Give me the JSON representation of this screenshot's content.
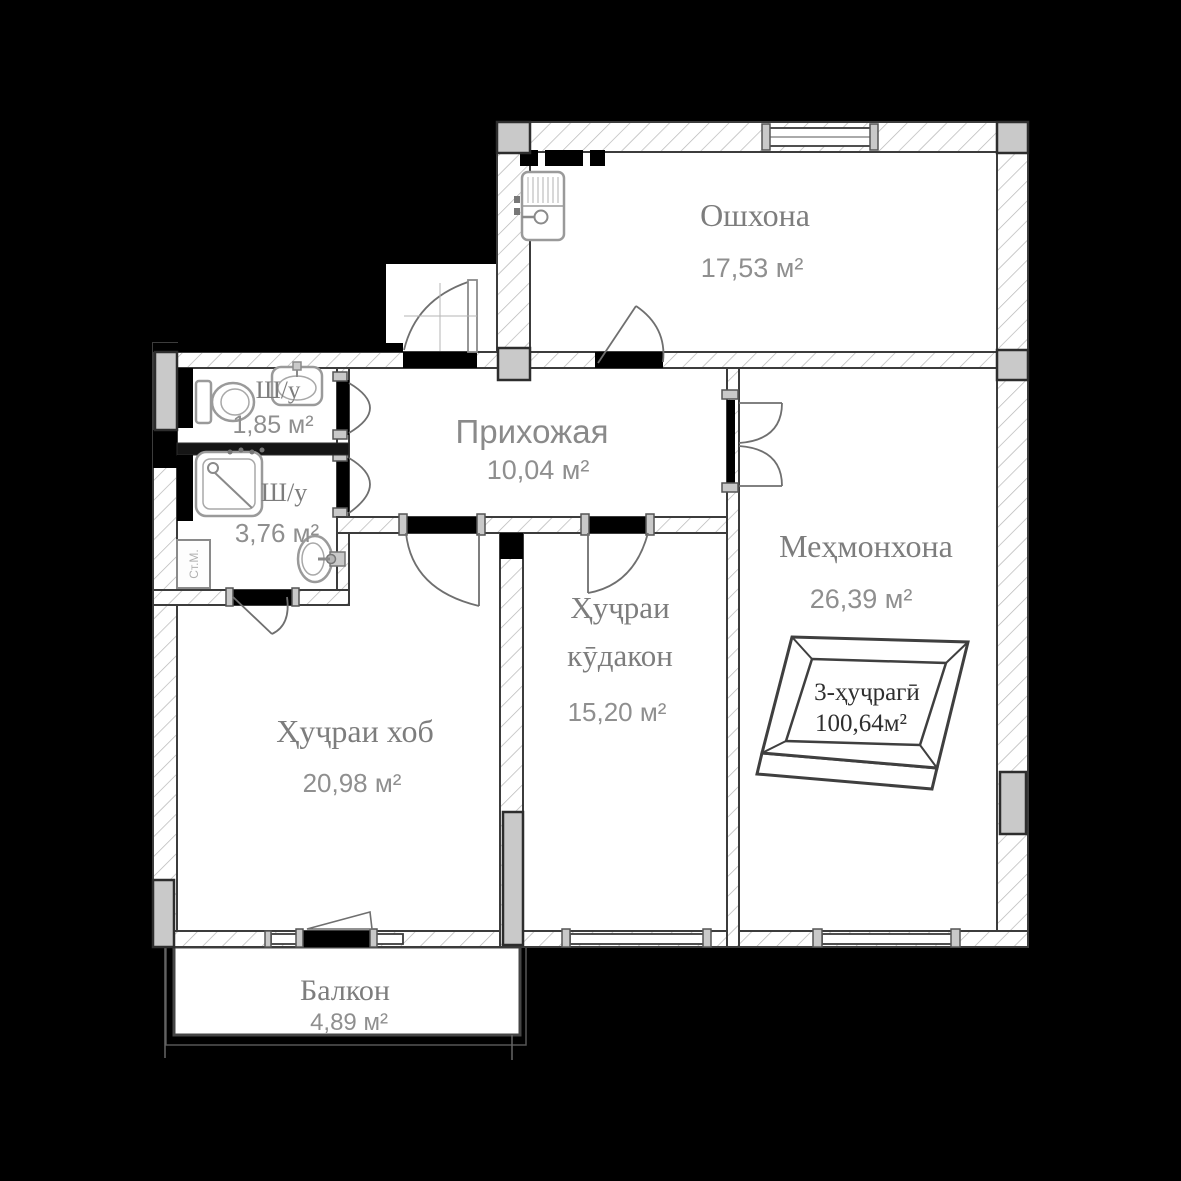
{
  "floorplan": {
    "unit_badge": {
      "type_label": "3-ҳуҷрагӣ",
      "total_area": "100,64м²"
    },
    "rooms": [
      {
        "id": "kitchen",
        "name": "Ошхона",
        "area": "17,53 м²"
      },
      {
        "id": "hallway",
        "name": "Прихожая",
        "area": "10,04 м²"
      },
      {
        "id": "living_room",
        "name": "Меҳмонхона",
        "area": "26,39 м²"
      },
      {
        "id": "children_room",
        "name_line1": "Ҳуҷраи",
        "name_line2": "кӯдакон",
        "area": "15,20 м²"
      },
      {
        "id": "bedroom",
        "name": "Ҳуҷраи хоб",
        "area": "20,98 м²"
      },
      {
        "id": "balcony",
        "name": "Балкон",
        "area": "4,89 м²"
      },
      {
        "id": "bathroom_small",
        "name": "Ш/у",
        "area": "1,85 м²"
      },
      {
        "id": "bathroom_big",
        "name": "Ш/у",
        "area": "3,76 м²"
      }
    ],
    "labels": {
      "washing_machine": "Ст.М."
    },
    "colors": {
      "background": "#000000",
      "floor": "#ffffff",
      "wall_outline": "#3c3c3c",
      "wall_hatch": "#b5b5b5",
      "pillar_fill": "#c9c9c9",
      "room_text": "#7d7d7d",
      "area_text": "#8f8f8f",
      "badge_text": "#2f2f2f"
    }
  }
}
